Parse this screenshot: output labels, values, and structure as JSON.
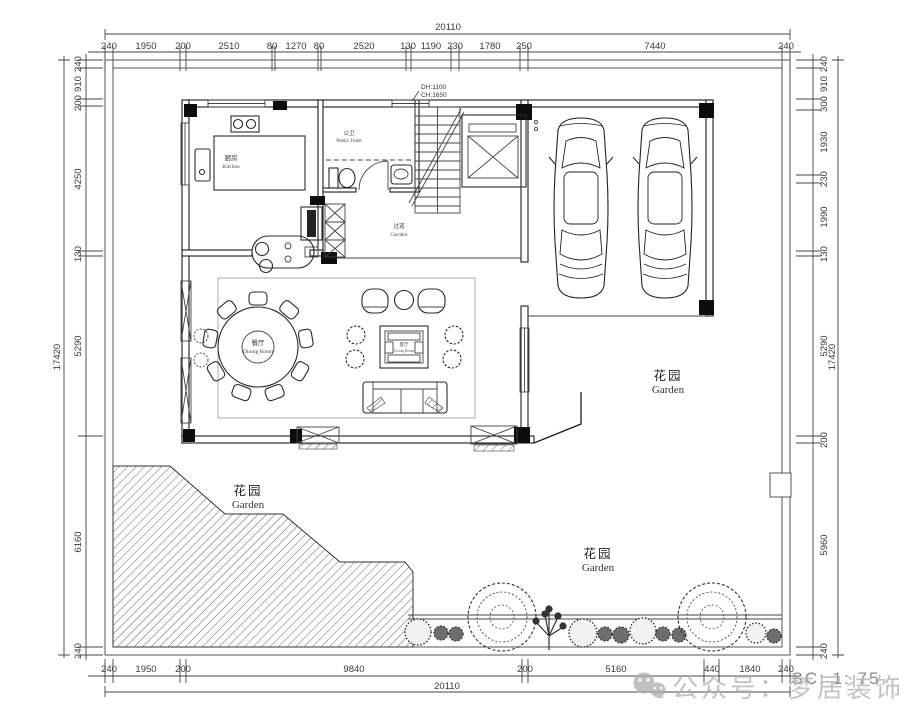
{
  "dimensions": {
    "top": {
      "total": "20110",
      "segments": [
        "240",
        "1950",
        "200",
        "2510",
        "80",
        "1270",
        "80",
        "2520",
        "130",
        "1190",
        "230",
        "1780",
        "250",
        "7440",
        "240"
      ]
    },
    "bottom": {
      "total": "20110",
      "segments": [
        "240",
        "1950",
        "200",
        "9840",
        "200",
        "5160",
        "440",
        "1840",
        "240"
      ]
    },
    "left": {
      "total": "17420",
      "segments": [
        "240",
        "910",
        "200",
        "4250",
        "130",
        "5290",
        "6160",
        "240"
      ]
    },
    "right": {
      "total": "17420",
      "segments": [
        "240",
        "910",
        "300",
        "1930",
        "230",
        "1990",
        "130",
        "5290",
        "200",
        "5960",
        "240"
      ]
    }
  },
  "rooms": {
    "kitchen": {
      "zh": "厨房",
      "en": "Kitchen"
    },
    "public_toilet": {
      "zh": "公卫",
      "en": "Public Toilet"
    },
    "corridor": {
      "zh": "过道",
      "en": "Corridor"
    },
    "dining_room": {
      "zh": "餐厅",
      "en": "Dining Room"
    },
    "living_room": {
      "zh": "客厅",
      "en": "Living Room"
    },
    "garden": {
      "zh": "花园",
      "en": "Garden"
    }
  },
  "annotations": {
    "dh": "DH:1100",
    "ch": "CH:1650"
  },
  "scale_note": "SC: 1: 75",
  "watermark": {
    "label": "公众号：梦居装饰",
    "icon": "wechat-icon"
  },
  "colors": {
    "line": "#1c1c1c",
    "dim_text": "#3a3a3a",
    "watermark_gray": "#b0b0b0"
  }
}
